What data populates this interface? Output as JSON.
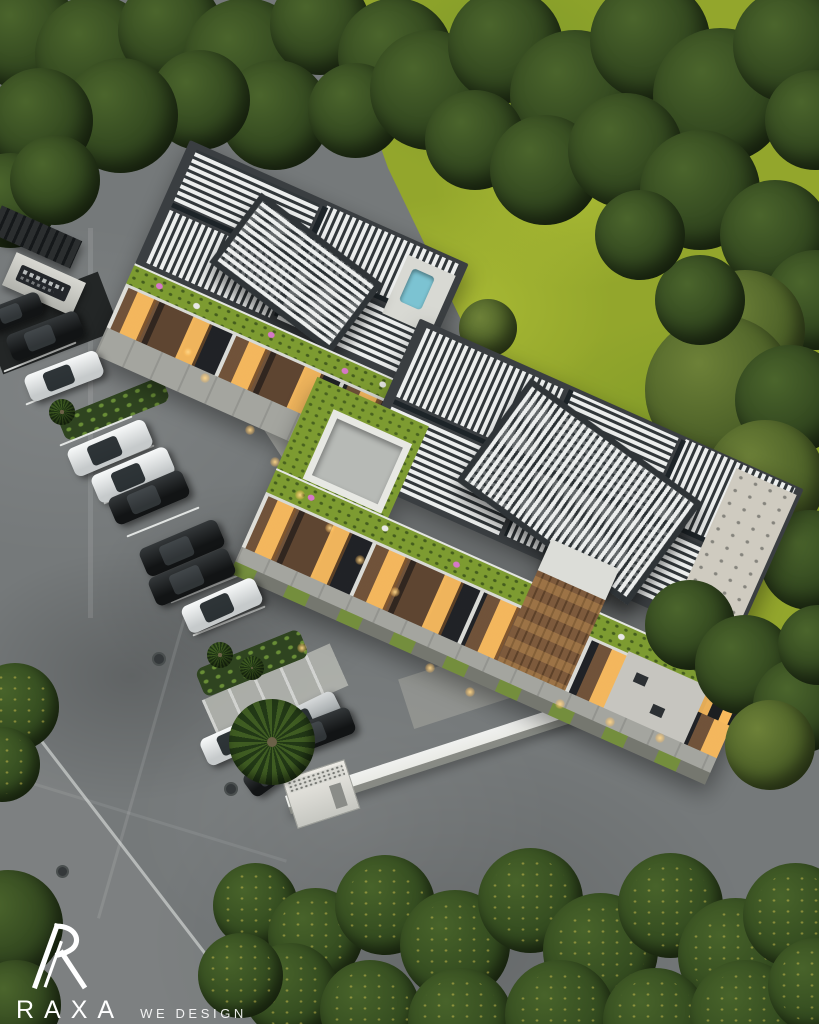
{
  "alt": "Aerial dusk 3D rendering of a modern two-block residential complex with white louvered pergola roofs, rooftop gardens with pink flowers, warm glowing windows, a side parking lot with cars, a white perimeter wall, surrounding lawns and dense dark green trees",
  "watermark": {
    "brand": "RAXA",
    "tagline": "WE DESIGN HAPPINESS"
  },
  "colors": {
    "asphalt": "#75797a",
    "lawn": "#93a62c",
    "lawnLight": "#a9ba34",
    "lawnDark": "#7f9a28",
    "roofFrame": "#3a3e41",
    "louver": "#eceeed",
    "roofGarden": "#7d9b31",
    "facadeDark": "#26282b",
    "windowGlow": "#f8ba5c",
    "woodBrown": "#7d5a3c",
    "wallWhite": "#e9eae5",
    "concrete": "#b7b9b3",
    "hedgeGreen": "#344c20",
    "carBlack": "#121415",
    "carWhite": "#f2f4f4",
    "carSilver": "#c2c6c7",
    "flowerPink": "#d678c8",
    "poolBlue": "#7cc3d2",
    "logoWhite": "#ffffff"
  },
  "scene": {
    "cars": [
      {
        "color": "black",
        "x": 14,
        "y": 312,
        "w": 58,
        "h": 24,
        "rot": -21
      },
      {
        "color": "black",
        "x": 45,
        "y": 336,
        "w": 76,
        "h": 28,
        "rot": -21
      },
      {
        "color": "white",
        "x": 64,
        "y": 376,
        "w": 78,
        "h": 28,
        "rot": -21
      },
      {
        "color": "white",
        "x": 110,
        "y": 448,
        "w": 84,
        "h": 30,
        "rot": -23
      },
      {
        "color": "white",
        "x": 133,
        "y": 475,
        "w": 82,
        "h": 30,
        "rot": -23
      },
      {
        "color": "black",
        "x": 149,
        "y": 497,
        "w": 80,
        "h": 29,
        "rot": -23
      },
      {
        "color": "black",
        "x": 182,
        "y": 548,
        "w": 84,
        "h": 30,
        "rot": -23
      },
      {
        "color": "black",
        "x": 192,
        "y": 577,
        "w": 86,
        "h": 30,
        "rot": -23
      },
      {
        "color": "white",
        "x": 222,
        "y": 605,
        "w": 80,
        "h": 29,
        "rot": -24
      },
      {
        "color": "silver",
        "x": 303,
        "y": 720,
        "w": 78,
        "h": 30,
        "rot": -26
      },
      {
        "color": "white",
        "x": 237,
        "y": 739,
        "w": 72,
        "h": 29,
        "rot": -24
      },
      {
        "color": "black",
        "x": 315,
        "y": 733,
        "w": 80,
        "h": 28,
        "rot": -21
      },
      {
        "color": "black",
        "x": 271,
        "y": 772,
        "w": 56,
        "h": 26,
        "rot": -36
      }
    ],
    "trees": [
      {
        "x": 25,
        "y": 35,
        "s": 110,
        "tone": "forest",
        "layer": "back"
      },
      {
        "x": 95,
        "y": 55,
        "s": 120,
        "tone": "forest",
        "layer": "back"
      },
      {
        "x": 170,
        "y": 30,
        "s": 105,
        "tone": "forest",
        "layer": "back"
      },
      {
        "x": 245,
        "y": 60,
        "s": 125,
        "tone": "forest",
        "layer": "back"
      },
      {
        "x": 320,
        "y": 25,
        "s": 100,
        "tone": "forest",
        "layer": "back"
      },
      {
        "x": 395,
        "y": 55,
        "s": 115,
        "tone": "forest",
        "layer": "back"
      },
      {
        "x": 275,
        "y": 115,
        "s": 110,
        "tone": "forest",
        "layer": "back"
      },
      {
        "x": 200,
        "y": 100,
        "s": 100,
        "tone": "forest",
        "layer": "back"
      },
      {
        "x": 120,
        "y": 115,
        "s": 115,
        "tone": "forest",
        "layer": "back"
      },
      {
        "x": 40,
        "y": 120,
        "s": 105,
        "tone": "forest",
        "layer": "back"
      },
      {
        "x": 10,
        "y": 200,
        "s": 95,
        "tone": "forest",
        "layer": "back"
      },
      {
        "x": 55,
        "y": 180,
        "s": 90,
        "tone": "forest",
        "layer": "back"
      },
      {
        "x": 355,
        "y": 110,
        "s": 95,
        "tone": "forest",
        "layer": "back"
      },
      {
        "x": 430,
        "y": 90,
        "s": 120,
        "tone": "forest",
        "layer": "back"
      },
      {
        "x": 505,
        "y": 45,
        "s": 115,
        "tone": "forest",
        "layer": "back"
      },
      {
        "x": 575,
        "y": 95,
        "s": 130,
        "tone": "forest",
        "layer": "back"
      },
      {
        "x": 650,
        "y": 40,
        "s": 120,
        "tone": "forest",
        "layer": "back"
      },
      {
        "x": 720,
        "y": 95,
        "s": 135,
        "tone": "forest",
        "layer": "back"
      },
      {
        "x": 790,
        "y": 45,
        "s": 115,
        "tone": "forest",
        "layer": "back"
      },
      {
        "x": 815,
        "y": 120,
        "s": 100,
        "tone": "forest",
        "layer": "back"
      },
      {
        "x": 475,
        "y": 140,
        "s": 100,
        "tone": "forest",
        "layer": "back"
      },
      {
        "x": 545,
        "y": 170,
        "s": 110,
        "tone": "forest",
        "layer": "back"
      },
      {
        "x": 625,
        "y": 150,
        "s": 115,
        "tone": "forest",
        "layer": "back"
      },
      {
        "x": 700,
        "y": 190,
        "s": 120,
        "tone": "forest",
        "layer": "back"
      },
      {
        "x": 775,
        "y": 235,
        "s": 110,
        "tone": "forest",
        "layer": "back"
      },
      {
        "x": 815,
        "y": 300,
        "s": 100,
        "tone": "forest",
        "layer": "back"
      },
      {
        "x": 745,
        "y": 330,
        "s": 120,
        "tone": "olive",
        "layer": "back"
      },
      {
        "x": 720,
        "y": 390,
        "s": 150,
        "tone": "olive",
        "layer": "back"
      },
      {
        "x": 790,
        "y": 400,
        "s": 110,
        "tone": "forest",
        "layer": "back"
      },
      {
        "x": 765,
        "y": 480,
        "s": 120,
        "tone": "olive",
        "layer": "back"
      },
      {
        "x": 810,
        "y": 560,
        "s": 100,
        "tone": "forest",
        "layer": "back"
      },
      {
        "x": 700,
        "y": 300,
        "s": 90,
        "tone": "forest",
        "layer": "back"
      },
      {
        "x": 640,
        "y": 235,
        "s": 90,
        "tone": "forest",
        "layer": "back"
      },
      {
        "x": 488,
        "y": 328,
        "s": 58,
        "tone": "olive",
        "layer": "back"
      },
      {
        "x": 690,
        "y": 625,
        "s": 90,
        "tone": "forest",
        "layer": "front"
      },
      {
        "x": 745,
        "y": 665,
        "s": 100,
        "tone": "forest",
        "layer": "front"
      },
      {
        "x": 800,
        "y": 705,
        "s": 95,
        "tone": "forest",
        "layer": "front"
      },
      {
        "x": 770,
        "y": 745,
        "s": 90,
        "tone": "olive",
        "layer": "front"
      },
      {
        "x": 818,
        "y": 645,
        "s": 80,
        "tone": "forest",
        "layer": "front"
      },
      {
        "x": 8,
        "y": 925,
        "s": 110,
        "tone": "forest",
        "layer": "front"
      },
      {
        "x": 16,
        "y": 1005,
        "s": 90,
        "tone": "forest",
        "layer": "front"
      },
      {
        "x": 15,
        "y": 707,
        "s": 88,
        "tone": "hedge",
        "layer": "front"
      },
      {
        "x": 2,
        "y": 764,
        "s": 75,
        "tone": "hedge",
        "layer": "front"
      },
      {
        "x": 255,
        "y": 905,
        "s": 85,
        "tone": "hedge",
        "layer": "front"
      },
      {
        "x": 315,
        "y": 935,
        "s": 95,
        "tone": "hedge",
        "layer": "front"
      },
      {
        "x": 385,
        "y": 905,
        "s": 100,
        "tone": "hedge",
        "layer": "front"
      },
      {
        "x": 455,
        "y": 945,
        "s": 110,
        "tone": "hedge",
        "layer": "front"
      },
      {
        "x": 530,
        "y": 900,
        "s": 105,
        "tone": "hedge",
        "layer": "front"
      },
      {
        "x": 600,
        "y": 950,
        "s": 115,
        "tone": "hedge",
        "layer": "front"
      },
      {
        "x": 670,
        "y": 905,
        "s": 105,
        "tone": "hedge",
        "layer": "front"
      },
      {
        "x": 735,
        "y": 955,
        "s": 115,
        "tone": "hedge",
        "layer": "front"
      },
      {
        "x": 795,
        "y": 915,
        "s": 105,
        "tone": "hedge",
        "layer": "front"
      },
      {
        "x": 290,
        "y": 990,
        "s": 95,
        "tone": "hedge",
        "layer": "front"
      },
      {
        "x": 370,
        "y": 1010,
        "s": 100,
        "tone": "hedge",
        "layer": "front"
      },
      {
        "x": 460,
        "y": 1020,
        "s": 105,
        "tone": "hedge",
        "layer": "front"
      },
      {
        "x": 560,
        "y": 1015,
        "s": 110,
        "tone": "hedge",
        "layer": "front"
      },
      {
        "x": 655,
        "y": 1020,
        "s": 105,
        "tone": "hedge",
        "layer": "front"
      },
      {
        "x": 745,
        "y": 1015,
        "s": 110,
        "tone": "hedge",
        "layer": "front"
      },
      {
        "x": 815,
        "y": 985,
        "s": 95,
        "tone": "hedge",
        "layer": "front"
      },
      {
        "x": 240,
        "y": 975,
        "s": 85,
        "tone": "hedge",
        "layer": "front"
      },
      {
        "x": 272,
        "y": 742,
        "s": 86,
        "tone": "palm",
        "layer": "front"
      },
      {
        "x": 220,
        "y": 655,
        "s": 26,
        "tone": "palm",
        "layer": "front"
      },
      {
        "x": 252,
        "y": 668,
        "s": 24,
        "tone": "palm",
        "layer": "front"
      },
      {
        "x": 62,
        "y": 412,
        "s": 26,
        "tone": "palm",
        "layer": "front"
      }
    ],
    "parking_lines": [
      {
        "x": 40,
        "y": 356,
        "len": 78,
        "rot": -22
      },
      {
        "x": 62,
        "y": 389,
        "len": 78,
        "rot": -22
      },
      {
        "x": 96,
        "y": 430,
        "len": 78,
        "rot": -22
      },
      {
        "x": 118,
        "y": 459,
        "len": 78,
        "rot": -22
      },
      {
        "x": 140,
        "y": 488,
        "len": 78,
        "rot": -22
      },
      {
        "x": 163,
        "y": 521,
        "len": 78,
        "rot": -22
      },
      {
        "x": 185,
        "y": 554,
        "len": 78,
        "rot": -22
      },
      {
        "x": 207,
        "y": 587,
        "len": 78,
        "rot": -22
      },
      {
        "x": 229,
        "y": 620,
        "len": 78,
        "rot": -22
      }
    ],
    "lights": [
      {
        "x": 250,
        "y": 430
      },
      {
        "x": 275,
        "y": 462
      },
      {
        "x": 300,
        "y": 495
      },
      {
        "x": 330,
        "y": 528
      },
      {
        "x": 360,
        "y": 560
      },
      {
        "x": 395,
        "y": 592
      },
      {
        "x": 302,
        "y": 648
      },
      {
        "x": 430,
        "y": 668
      },
      {
        "x": 470,
        "y": 692
      },
      {
        "x": 560,
        "y": 704
      },
      {
        "x": 610,
        "y": 722
      },
      {
        "x": 660,
        "y": 738
      },
      {
        "x": 205,
        "y": 378
      },
      {
        "x": 188,
        "y": 352
      }
    ],
    "manholes": [
      {
        "x": 159,
        "y": 659,
        "s": 14
      },
      {
        "x": 231,
        "y": 789,
        "s": 14
      },
      {
        "x": 62,
        "y": 871,
        "s": 13
      }
    ]
  }
}
